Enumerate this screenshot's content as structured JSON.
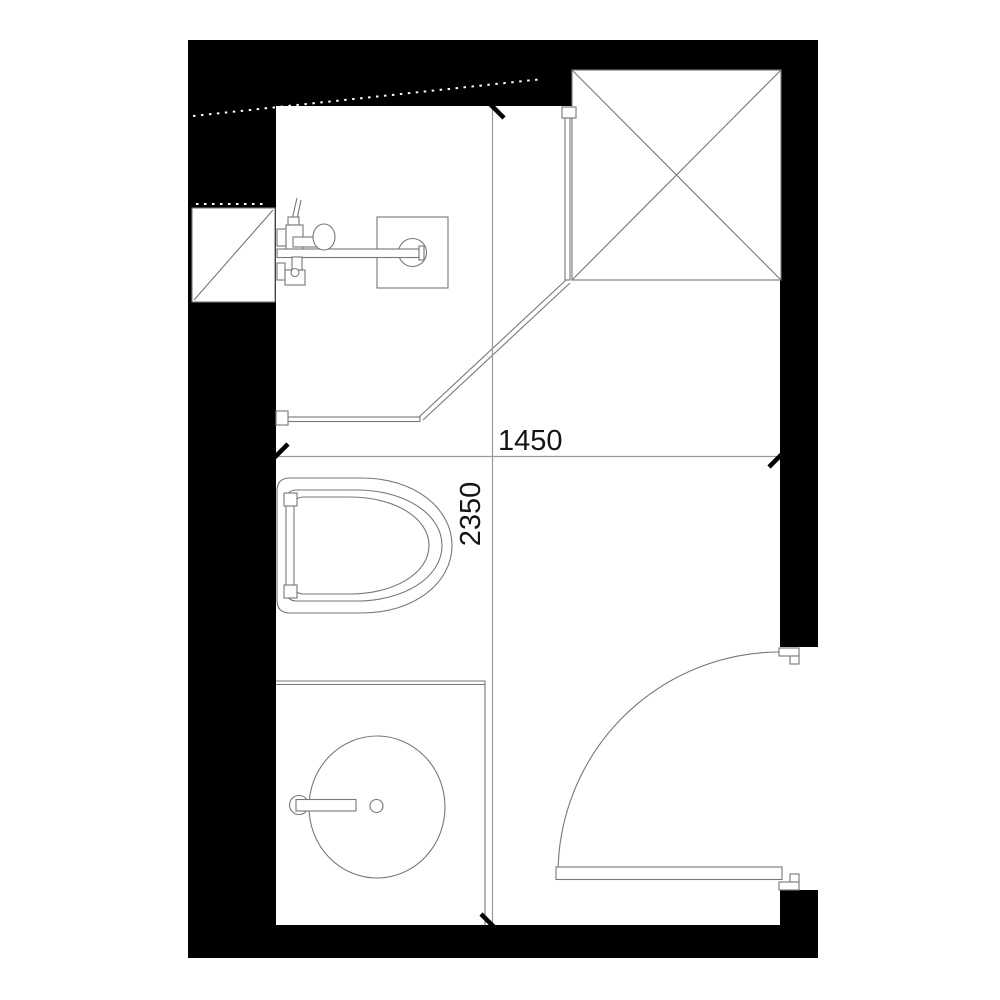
{
  "plan": {
    "name": "bathroom-floor-plan",
    "dimensions": {
      "horizontal": {
        "value": "1450"
      },
      "vertical": {
        "value": "2350"
      }
    },
    "fixtures": [
      "crossed-shaft-box",
      "duct-shaft-box",
      "shower-glass-panel",
      "shower-mixer",
      "shower-head-plate",
      "wall-hung-toilet",
      "vanity-counter",
      "round-washbasin",
      "basin-tap",
      "swing-door"
    ],
    "colors": {
      "wall": "#000000",
      "line": "#777777",
      "dim": "#9a9a9a",
      "text": "#141414",
      "background": "#ffffff"
    }
  }
}
